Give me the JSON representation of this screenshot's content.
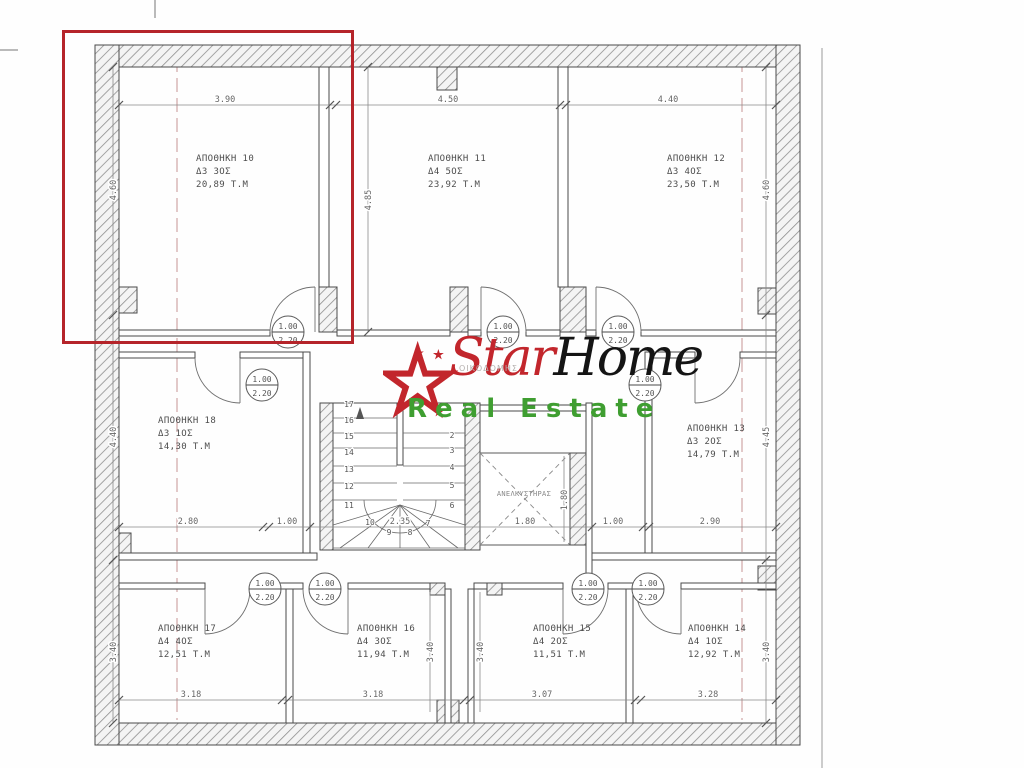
{
  "logo": {
    "star_word": "Star",
    "home_word": "Home",
    "tagline": "Real Estate",
    "watermark_small": "ΟΙΚΟΔΟΜΗΣ",
    "red": "#c2262c",
    "green": "#3f9e31"
  },
  "highlight_color": "#b5242a",
  "rooms": [
    {
      "name": "ΑΠΟΘΗΚΗ 10",
      "unit": "Δ3 3ΟΣ",
      "area": "20,89 Τ.Μ"
    },
    {
      "name": "ΑΠΟΘΗΚΗ 11",
      "unit": "Δ4 5ΟΣ",
      "area": "23,92 Τ.Μ"
    },
    {
      "name": "ΑΠΟΘΗΚΗ 12",
      "unit": "Δ3 4ΟΣ",
      "area": "23,50 Τ.Μ"
    },
    {
      "name": "ΑΠΟΘΗΚΗ 13",
      "unit": "Δ3 2ΟΣ",
      "area": "14,79 Τ.Μ"
    },
    {
      "name": "ΑΠΟΘΗΚΗ 14",
      "unit": "Δ4 1ΟΣ",
      "area": "12,92 Τ.Μ"
    },
    {
      "name": "ΑΠΟΘΗΚΗ 15",
      "unit": "Δ4 2ΟΣ",
      "area": "11,51 Τ.Μ"
    },
    {
      "name": "ΑΠΟΘΗΚΗ 16",
      "unit": "Δ4 3ΟΣ",
      "area": "11,94 Τ.Μ"
    },
    {
      "name": "ΑΠΟΘΗΚΗ 17",
      "unit": "Δ4 4ΟΣ",
      "area": "12,51 Τ.Μ"
    },
    {
      "name": "ΑΠΟΘΗΚΗ 18",
      "unit": "Δ3 1ΟΣ",
      "area": "14,30 Τ.Μ"
    }
  ],
  "elevator": {
    "label": "ΑΝΕΛΚΥΣΤΗΡΑΣ"
  },
  "door": {
    "width": "1.00",
    "height": "2.20"
  },
  "stairs": {
    "left": [
      "17",
      "16",
      "15",
      "14",
      "13",
      "12",
      "11"
    ],
    "right": [
      "2",
      "3",
      "4",
      "5",
      "6"
    ],
    "bottom": [
      "10",
      "9",
      "8",
      "7"
    ]
  },
  "dims": {
    "top": [
      "3.90",
      "4.50",
      "4.40"
    ],
    "mid": [
      "2.80",
      "1.00",
      "2.35",
      "1.80",
      "1.00",
      "2.90"
    ],
    "bottom": [
      "3.18",
      "3.18",
      "3.07",
      "3.28"
    ],
    "left": [
      "4.60",
      "4.40",
      "3.40"
    ],
    "right": [
      "4.60",
      "4.45",
      "3.40"
    ],
    "room11": "4.85",
    "shaft": [
      "3.40",
      "3.40"
    ],
    "elevator_w": "1.80",
    "elevator_h": "1.80"
  }
}
